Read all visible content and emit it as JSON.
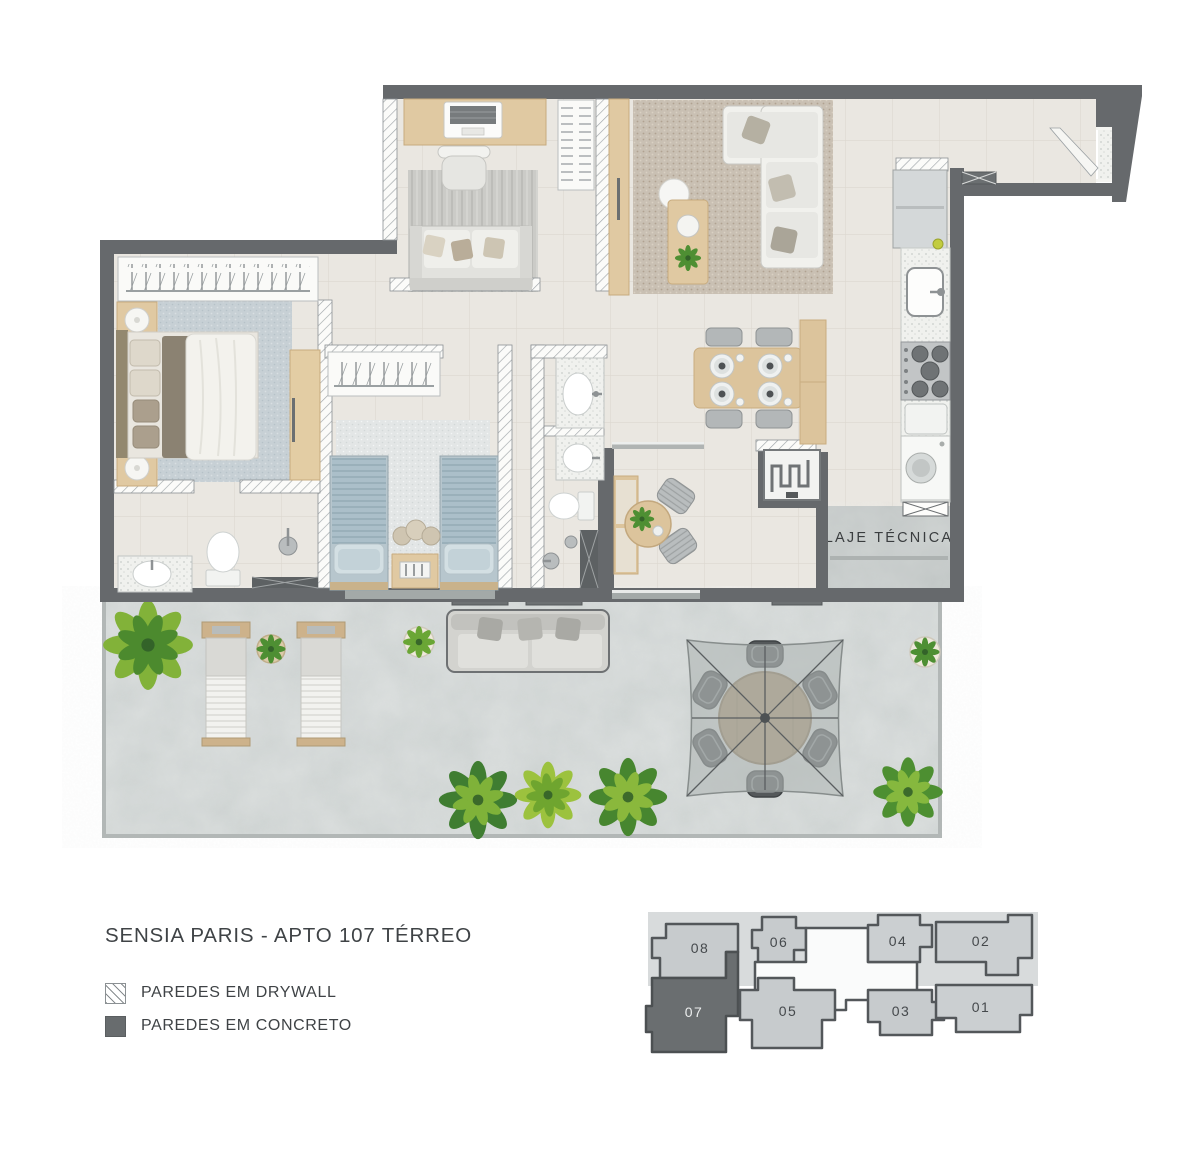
{
  "title": "SENSIA PARIS - APTO 107 TÉRREO",
  "legend": {
    "drywall": "PAREDES EM DRYWALL",
    "concrete": "PAREDES EM CONCRETO"
  },
  "plan": {
    "laje_label": "LAJE TÉCNICA"
  },
  "keyplan": {
    "highlighted_unit": "07",
    "top_row": [
      "08",
      "06",
      "04",
      "02"
    ],
    "bottom_row": [
      "07",
      "05",
      "03",
      "01"
    ]
  },
  "colors": {
    "concrete_wall": "#66696c",
    "drywall": "#ffffff",
    "interior_floor": "#eae7e1",
    "terrace_floor": "#ced3d2",
    "wood_light": "#e0c9a2",
    "wood_dark": "#a8916f",
    "plant_green": "#7fb239",
    "keyplan_unit_fill": "#c7cbcd",
    "keyplan_core_fill": "#fafbfb",
    "keyplan_highlight_fill": "#6a6e70"
  }
}
